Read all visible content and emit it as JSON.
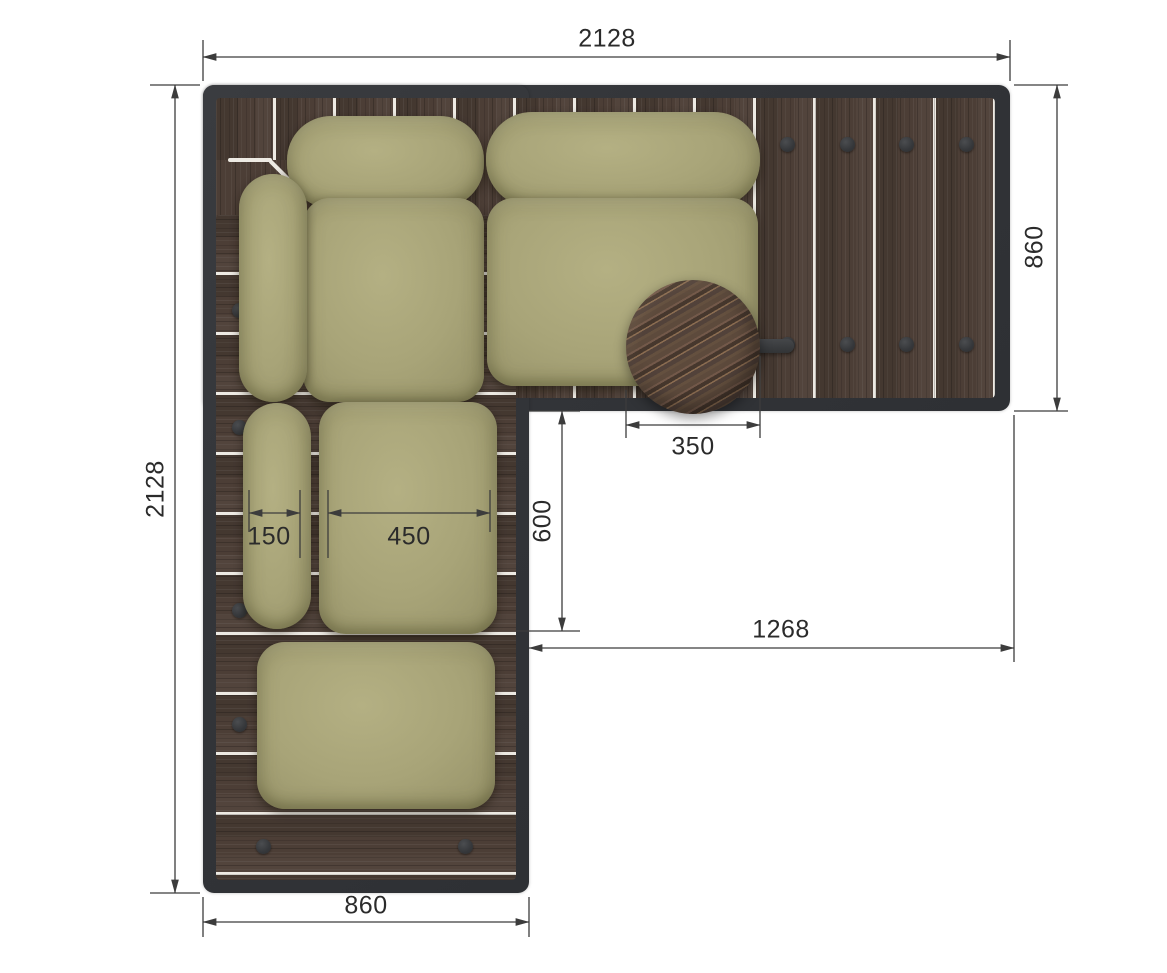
{
  "drawing": {
    "kind": "corner-sofa top-view plan",
    "dimensions_mm": {
      "overall_width": "2128",
      "overall_height": "2128",
      "right_section_depth": "860",
      "left_section_width": "860",
      "table_diameter": "350",
      "inner_corner_offset": "600",
      "inner_clear_width": "1268",
      "back_cushion_width": "150",
      "seat_cushion_width": "450"
    },
    "colors": {
      "background": "#ffffff",
      "frame": "#34363a",
      "wood_deck": "#4c3e36",
      "plank_gap": "#edeae3",
      "cushion": "#a8a478",
      "table_wood": "#5d4a3c",
      "dimension_line": "#3c3c3c",
      "dimension_text": "#2b2b2b"
    }
  }
}
